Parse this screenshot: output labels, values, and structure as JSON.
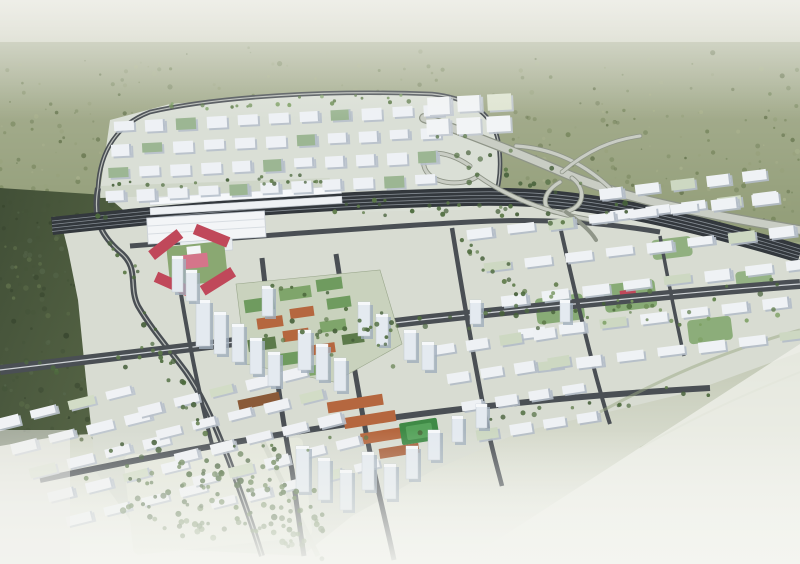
{
  "meta": {
    "description": "Aerial bird's-eye architectural rendering of a transit-oriented urban master plan: a high-speed railway station with long platform canopies, a red-roofed landmark cluster, a mixed-use core with green and terracotta roofs, white residential slab districts, a looping highway interchange on the east, surrounded by hazy green forest that fades to white mist at the horizon and foreground."
  },
  "palette": {
    "hazeTop": "#d3d4c7",
    "forestFar": "#97a17c",
    "forestMid": "#76855c",
    "forestDark": "#46553a",
    "ground": "#d8dcd2",
    "groundNorth": "#dadfd6",
    "road": "#4a4f54",
    "roadLight": "#c9cdc4",
    "roadEdge": "#8f9588",
    "rail": "#33383d",
    "railLine": "#868d94",
    "buildingFace": "#eef1f5",
    "buildingSide": "#b7c0cb",
    "towerFace": "#e4eaf0",
    "towerSide": "#a0aebc",
    "greenGlass": "#9cb693",
    "roofGreen": "#6f9b5f",
    "parkGreen": "#7fa56b",
    "treeDark": "#4e6b3e",
    "terracotta": "#b5673f",
    "terracottaDark": "#8a5a38",
    "red": "#c0485a",
    "pink": "#d4758a",
    "field": "#3f8a46",
    "hazeBottom": "#f4f5f0"
  },
  "scene": {
    "forest": {
      "bandDots": 520,
      "leftDots": 240
    },
    "districts": [
      {
        "name": "north-grid",
        "x": 116,
        "y": 112,
        "rows": 4,
        "cols": 11,
        "bw": 20,
        "bh": 9,
        "gx": 11,
        "gy": 14,
        "rowShift": -4,
        "rot": -3,
        "cx": 300,
        "cy": 160,
        "face": "#eef1f5",
        "side": "#b7c0cb",
        "accent": "#9cb693",
        "accentEvery": 5
      },
      {
        "name": "north-bigbox",
        "x": 428,
        "y": 96,
        "rows": 2,
        "cols": 3,
        "bw": 24,
        "bh": 15,
        "gx": 6,
        "gy": 7,
        "rowShift": -2,
        "rot": -3,
        "cx": 460,
        "cy": 115,
        "face": "#f2f4f6",
        "side": "#c2c9d2",
        "accent": "#dfe5d2",
        "accentEvery": 4
      },
      {
        "name": "ne-strip",
        "x": 600,
        "y": 182,
        "rows": 2,
        "cols": 5,
        "bw": 24,
        "bh": 8,
        "gx": 12,
        "gy": 15,
        "rowShift": 8,
        "rot": -7,
        "cx": 660,
        "cy": 195,
        "face": "#eff2f5",
        "side": "#b4bdc8",
        "accent": "#cdd8c2",
        "accentEvery": 6
      },
      {
        "name": "east-res",
        "x": 476,
        "y": 212,
        "rows": 5,
        "cols": 8,
        "bw": 27,
        "bh": 8,
        "gx": 14,
        "gy": 27,
        "rowShift": 13,
        "rot": -7,
        "cx": 620,
        "cy": 300,
        "face": "#eff2f5",
        "side": "#b4bdc8",
        "accent": "#cdd8c2",
        "accentEvery": 6
      },
      {
        "name": "mid-south",
        "x": 438,
        "y": 336,
        "rows": 4,
        "cols": 4,
        "bw": 22,
        "bh": 8,
        "gx": 12,
        "gy": 22,
        "rowShift": 10,
        "rot": -9,
        "cx": 500,
        "cy": 380,
        "face": "#eef1f4",
        "side": "#b2bbc6",
        "accent": "#cdd8c2",
        "accentEvery": 5
      },
      {
        "name": "sw-res",
        "x": 4,
        "y": 400,
        "rows": 5,
        "cols": 4,
        "bw": 27,
        "bh": 8,
        "gx": 12,
        "gy": 20,
        "rowShift": 12,
        "rot": -14,
        "cx": 80,
        "cy": 460,
        "face": "#f0f2f5",
        "side": "#bcc4ce",
        "accent": "#d2dcc6",
        "accentEvery": 6
      },
      {
        "name": "s-res",
        "x": 148,
        "y": 386,
        "rows": 5,
        "cols": 5,
        "bw": 25,
        "bh": 8,
        "gx": 12,
        "gy": 19,
        "rowShift": 12,
        "rot": -14,
        "cx": 230,
        "cy": 440,
        "face": "#eff1f4",
        "side": "#b8c0ca",
        "accent": "#d2dcc6",
        "accentEvery": 7
      }
    ],
    "towers": [
      [
        196,
        300,
        14,
        46
      ],
      [
        214,
        312,
        12,
        42
      ],
      [
        232,
        324,
        12,
        38
      ],
      [
        250,
        338,
        12,
        36
      ],
      [
        268,
        352,
        12,
        34
      ],
      [
        298,
        330,
        13,
        40
      ],
      [
        316,
        344,
        12,
        36
      ],
      [
        334,
        358,
        12,
        33
      ],
      [
        358,
        302,
        12,
        34
      ],
      [
        376,
        314,
        12,
        31
      ],
      [
        404,
        330,
        12,
        30
      ],
      [
        422,
        342,
        12,
        28
      ],
      [
        172,
        256,
        11,
        36
      ],
      [
        186,
        270,
        11,
        31
      ],
      [
        262,
        286,
        11,
        30
      ],
      [
        296,
        446,
        13,
        46
      ],
      [
        318,
        458,
        12,
        42
      ],
      [
        340,
        470,
        12,
        40
      ],
      [
        362,
        452,
        12,
        38
      ],
      [
        384,
        464,
        12,
        35
      ],
      [
        406,
        446,
        12,
        33
      ],
      [
        428,
        430,
        12,
        30
      ],
      [
        452,
        416,
        11,
        26
      ],
      [
        476,
        404,
        11,
        24
      ],
      [
        470,
        300,
        11,
        24
      ],
      [
        560,
        300,
        10,
        22
      ]
    ],
    "treeBelts": [
      {
        "n": 46,
        "x0": 0,
        "y0": 372,
        "x1": 800,
        "y1": 286,
        "spread": 9,
        "r": 2.2,
        "set": "dark"
      },
      {
        "n": 24,
        "x0": 40,
        "y0": 480,
        "x1": 710,
        "y1": 388,
        "spread": 7,
        "r": 2.0,
        "set": "dark"
      },
      {
        "n": 22,
        "x0": 150,
        "y0": 108,
        "x1": 430,
        "y1": 96,
        "spread": 5,
        "r": 1.8,
        "set": "light"
      },
      {
        "n": 20,
        "x0": 110,
        "y0": 186,
        "x1": 330,
        "y1": 178,
        "spread": 4,
        "r": 1.8,
        "set": "dark"
      },
      {
        "n": 22,
        "x0": 340,
        "y0": 206,
        "x1": 520,
        "y1": 212,
        "spread": 8,
        "r": 2.0,
        "set": "dark"
      },
      {
        "n": 30,
        "x0": 100,
        "y0": 210,
        "x1": 250,
        "y1": 545,
        "spread": 10,
        "r": 2.2,
        "set": "dark"
      },
      {
        "n": 20,
        "x0": 240,
        "y0": 282,
        "x1": 400,
        "y1": 350,
        "spread": 26,
        "r": 2.0,
        "set": "dark"
      },
      {
        "n": 22,
        "x0": 540,
        "y0": 300,
        "x1": 770,
        "y1": 330,
        "spread": 26,
        "r": 2.0,
        "set": "light"
      },
      {
        "n": 70,
        "x0": 138,
        "y0": 470,
        "x1": 248,
        "y1": 520,
        "spread": 34,
        "r": 2.5,
        "set": "dark"
      },
      {
        "n": 55,
        "x0": 258,
        "y0": 470,
        "x1": 310,
        "y1": 540,
        "spread": 26,
        "r": 2.5,
        "set": "dark"
      },
      {
        "n": 26,
        "x0": 440,
        "y0": 150,
        "x1": 620,
        "y1": 230,
        "spread": 30,
        "r": 2.2,
        "set": "dark"
      },
      {
        "n": 18,
        "x0": 470,
        "y0": 240,
        "x1": 540,
        "y1": 320,
        "spread": 12,
        "r": 2.0,
        "set": "dark"
      }
    ]
  }
}
